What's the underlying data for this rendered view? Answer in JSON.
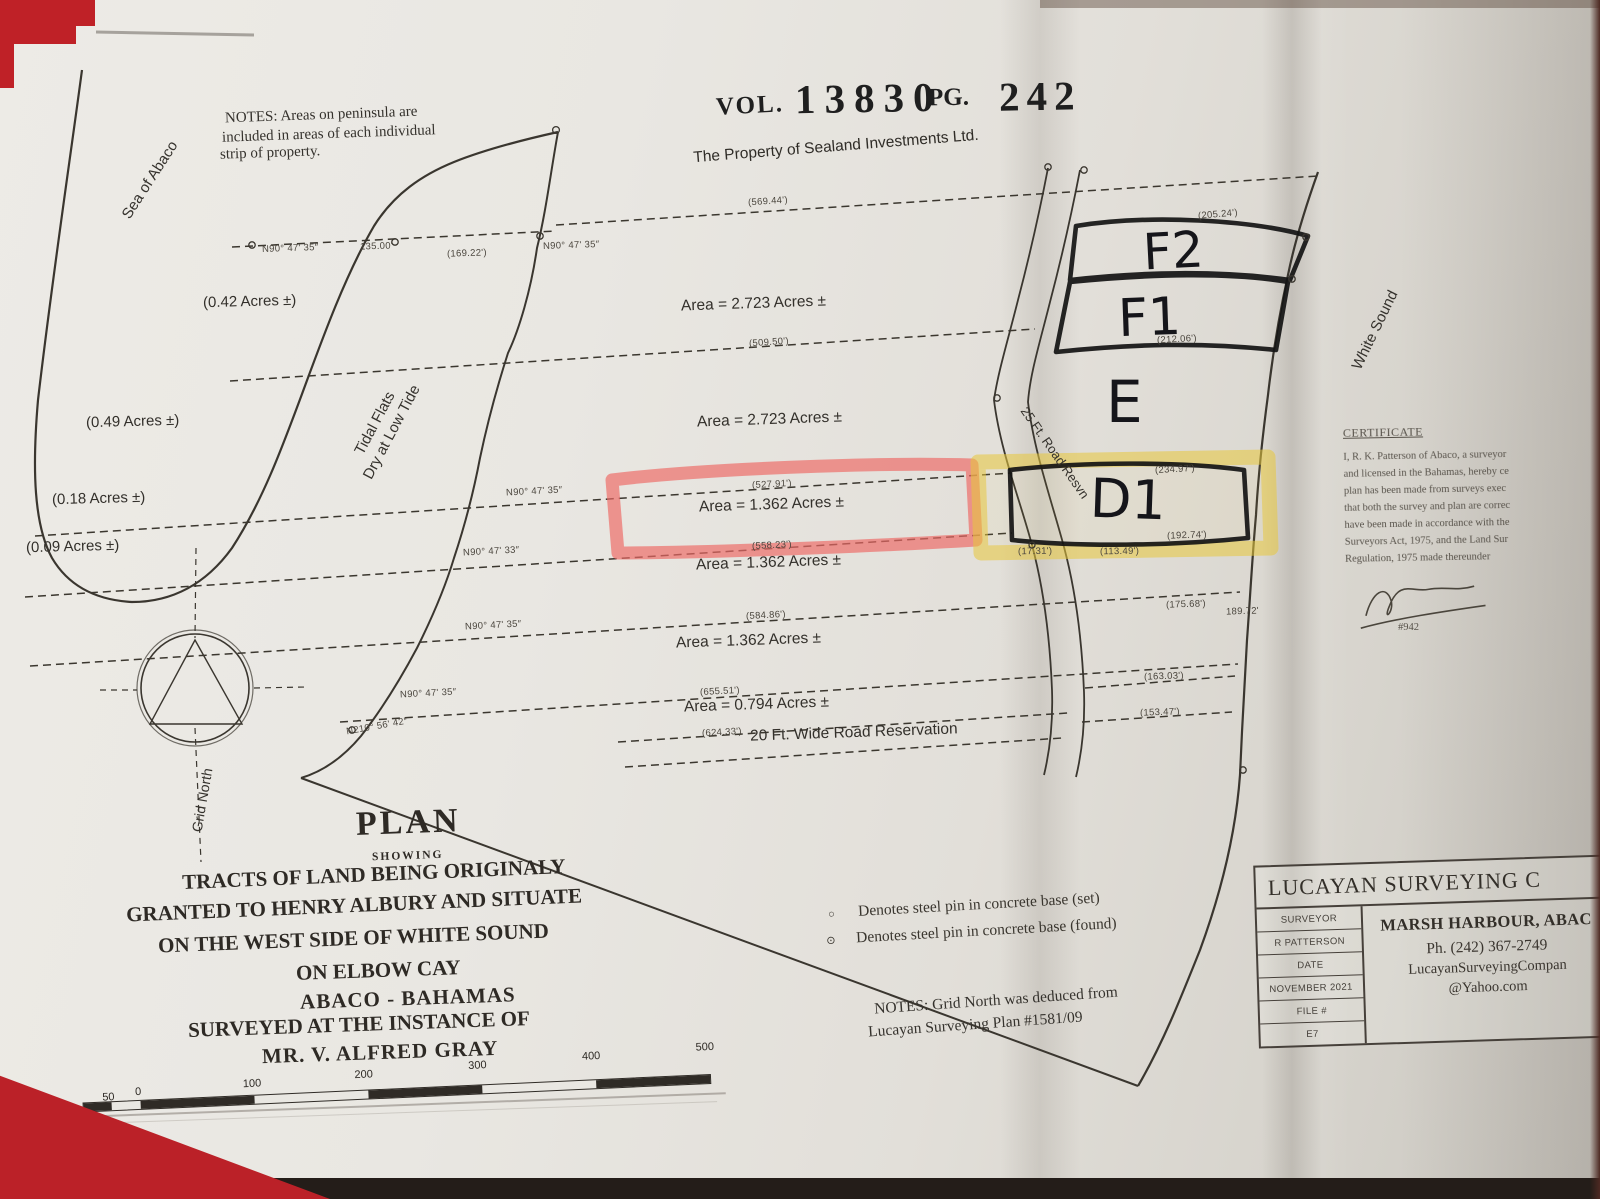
{
  "stamp": {
    "vol": "VOL.",
    "vol_num": "13830",
    "pg": "PG.",
    "pg_num": "242"
  },
  "subtitle": "The Property of Sealand Investments Ltd.",
  "notes_top": [
    "NOTES: Areas on peninsula are",
    "included in areas of each individual",
    "strip of property."
  ],
  "water": {
    "sea": "Sea of Abaco",
    "tidal1": "Tidal Flats",
    "tidal2": "Dry at Low Tide",
    "white_sound": "White Sound"
  },
  "peninsula_areas": [
    "(0.42 Acres ±)",
    "(0.49 Acres ±)",
    "(0.18 Acres ±)",
    "(0.09 Acres ±)"
  ],
  "strip_areas": [
    "Area = 2.723 Acres ±",
    "Area = 2.723 Acres ±",
    "Area = 1.362 Acres ±",
    "Area = 1.362 Acres ±",
    "Area = 1.362 Acres ±",
    "Area = 0.794 Acres ±"
  ],
  "roads": {
    "r25": "25 Ft. Road Resvn",
    "r20": "20 Ft. Wide Road Reservation"
  },
  "lots": [
    "F2",
    "F1",
    "E",
    "D1"
  ],
  "compass_label": "Grid North",
  "dims": [
    "(569.44')",
    "(509.50')",
    "(527.91')",
    "(558.23')",
    "(584.86')",
    "(655.51')",
    "(624.33')",
    "N90° 47' 35″",
    "135.00'",
    "(169.22')",
    "N90° 47' 35″",
    "N90° 47' 35″",
    "N90° 47' 33″",
    "N90° 47' 35″",
    "N90° 47' 35″",
    "(205.24')",
    "(212.06')",
    "(234.97')",
    "(192.74')",
    "(175.68')",
    "189.72'",
    "(113.49')",
    "(17.31')",
    "(163.03')",
    "(153.47')",
    "N210° 56' 42″"
  ],
  "legend": [
    {
      "symbol": "○",
      "text": "Denotes steel pin in concrete base (set)"
    },
    {
      "symbol": "⊙",
      "text": "Denotes steel pin in concrete base (found)"
    }
  ],
  "notes_bottom": [
    "NOTES: Grid North was deduced from",
    "Lucayan Surveying Plan #1581/09"
  ],
  "title_block": [
    "PLAN",
    "SHOWING",
    "TRACTS OF LAND BEING ORIGINALY",
    "GRANTED TO HENRY ALBURY AND SITUATE",
    "ON THE WEST SIDE OF WHITE SOUND",
    "ON ELBOW CAY",
    "ABACO - BAHAMAS",
    "SURVEYED AT THE INSTANCE OF",
    "MR. V. ALFRED GRAY"
  ],
  "firm": {
    "title": "LUCAYAN SURVEYING C",
    "rows": [
      "SURVEYOR",
      "R PATTERSON",
      "DATE",
      "NOVEMBER 2021",
      "FILE #",
      "E7"
    ],
    "address": "MARSH HARBOUR, ABAC",
    "phone": "Ph. (242) 367-2749",
    "email1": "LucayanSurveyingCompan",
    "email2": "@Yahoo.com"
  },
  "certificate": {
    "title": "CERTIFICATE",
    "lines": [
      "I, R. K. Patterson of Abaco, a surveyor",
      "and licensed in the Bahamas, hereby ce",
      "plan has been made from surveys exec",
      "that both the survey and plan are correc",
      "have been made in accordance with the",
      "Surveyors Act, 1975, and the Land Sur",
      "Regulation, 1975 made thereunder"
    ],
    "reg": "#942"
  },
  "scale_labels": [
    "50",
    "0",
    "100",
    "200",
    "300",
    "400",
    "500"
  ]
}
